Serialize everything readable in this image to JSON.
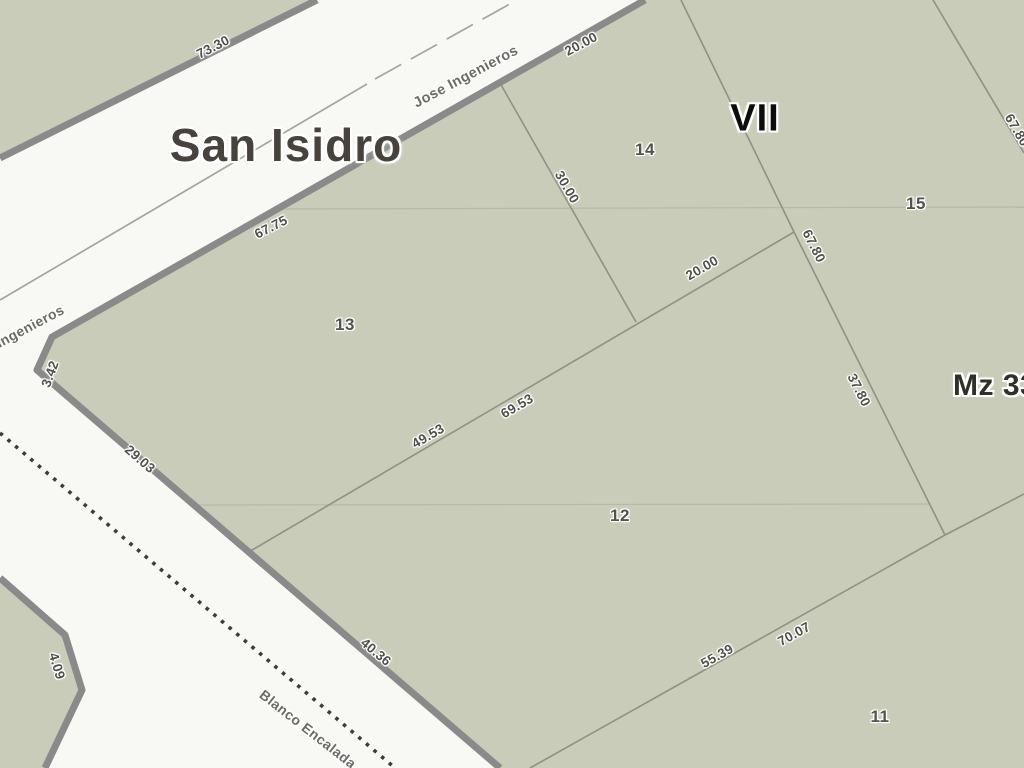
{
  "title": {
    "region": "San Isidro",
    "section": "VII",
    "block": "Mz 33"
  },
  "streets": {
    "jose_ingenieros": "Jose Ingenieros",
    "jose_ingenieros_partial": "ingenieros",
    "blanco_encalada": "Blanco Encalada"
  },
  "parcels": {
    "p11": "11",
    "p12": "12",
    "p13": "13",
    "p14": "14",
    "p15": "15"
  },
  "dimensions": {
    "d73_30": "73.30",
    "d20_00_road": "20.00",
    "d67_75": "67.75",
    "d30_00": "30.00",
    "d3_42": "3.42",
    "d29_03": "29.03",
    "d40_36": "40.36",
    "d4_09": "4.09",
    "d49_53": "49.53",
    "d69_53": "69.53",
    "d20_00_inner": "20.00",
    "d67_80_inner": "67.80",
    "d37_80": "37.80",
    "d67_80_right": "67.80",
    "d55_39": "55.39",
    "d70_07": "70.07"
  },
  "colors": {
    "parcel_fill": "#c8ccb8",
    "road_fill": "#f8f8f5",
    "road_edge": "#8a8a8a",
    "parcel_line": "#8e9184",
    "faint_line": "#b7baa9",
    "centerline": "#a3a69b",
    "dotted_boundary": "#3c3c38",
    "label_text": "#50504a",
    "street_text": "#6b6b66",
    "parcelnum_text": "#53534b",
    "region_text": "#47423b",
    "section_text": "#0c0c0c",
    "block_text": "#303029"
  }
}
